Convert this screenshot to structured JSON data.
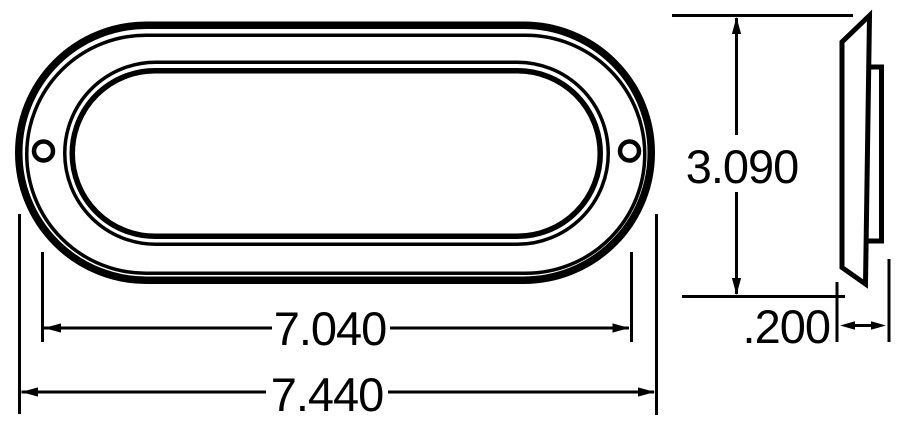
{
  "drawing": {
    "type": "technical-dimension-drawing",
    "subject": "oval flange-mount lamp",
    "background_color": "#ffffff",
    "line_color": "#000000",
    "views": {
      "front_view": {
        "name": "front view",
        "features": [
          "outer-flange-outline",
          "flange-inner-edge",
          "lens-bezel-outer-ring",
          "lens-bezel-inner-ring",
          "left-mounting-hole",
          "right-mounting-hole"
        ]
      },
      "side_view": {
        "name": "side profile view",
        "features": [
          "flange-plate-profile",
          "lamp-body-protrusion"
        ]
      }
    },
    "dimensions": {
      "lens_width": {
        "label": "7.040",
        "orientation": "horizontal"
      },
      "overall_width": {
        "label": "7.440",
        "orientation": "horizontal"
      },
      "overall_height": {
        "label": "3.090",
        "orientation": "vertical"
      },
      "flange_depth": {
        "label": ".200",
        "orientation": "horizontal"
      }
    }
  }
}
